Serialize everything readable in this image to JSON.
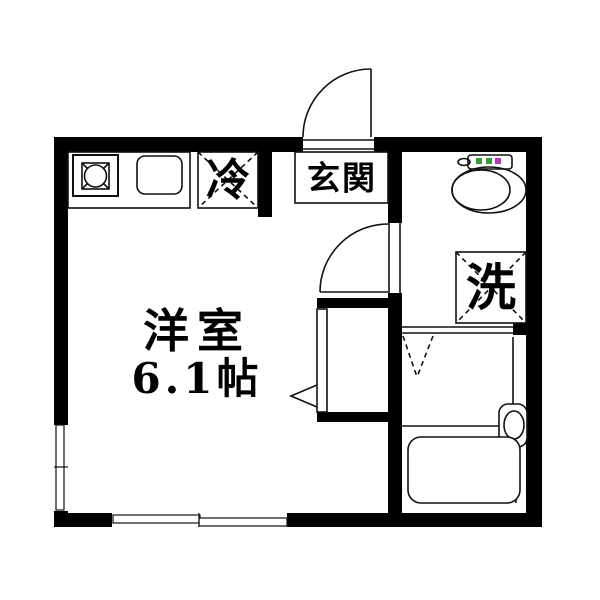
{
  "floor_plan": {
    "labels": {
      "main_room_name": "洋室",
      "main_room_area": "6.1帖",
      "entrance": "玄関",
      "refrigerator": "冷",
      "washing_machine": "洗"
    },
    "colors": {
      "wall": "#000000",
      "floor": "#ffffff",
      "outline": "#111111",
      "toilet_button_green": "#3a9b3a",
      "toilet_button_pink": "#b23ab2"
    },
    "fixtures": [
      "gas-stove",
      "kitchen-sink",
      "refrigerator-space",
      "entrance-door",
      "toilet",
      "washing-machine-space",
      "interior-door",
      "closet",
      "folding-door-marker",
      "washbasin",
      "bathtub",
      "window-left",
      "window-bottom"
    ]
  }
}
